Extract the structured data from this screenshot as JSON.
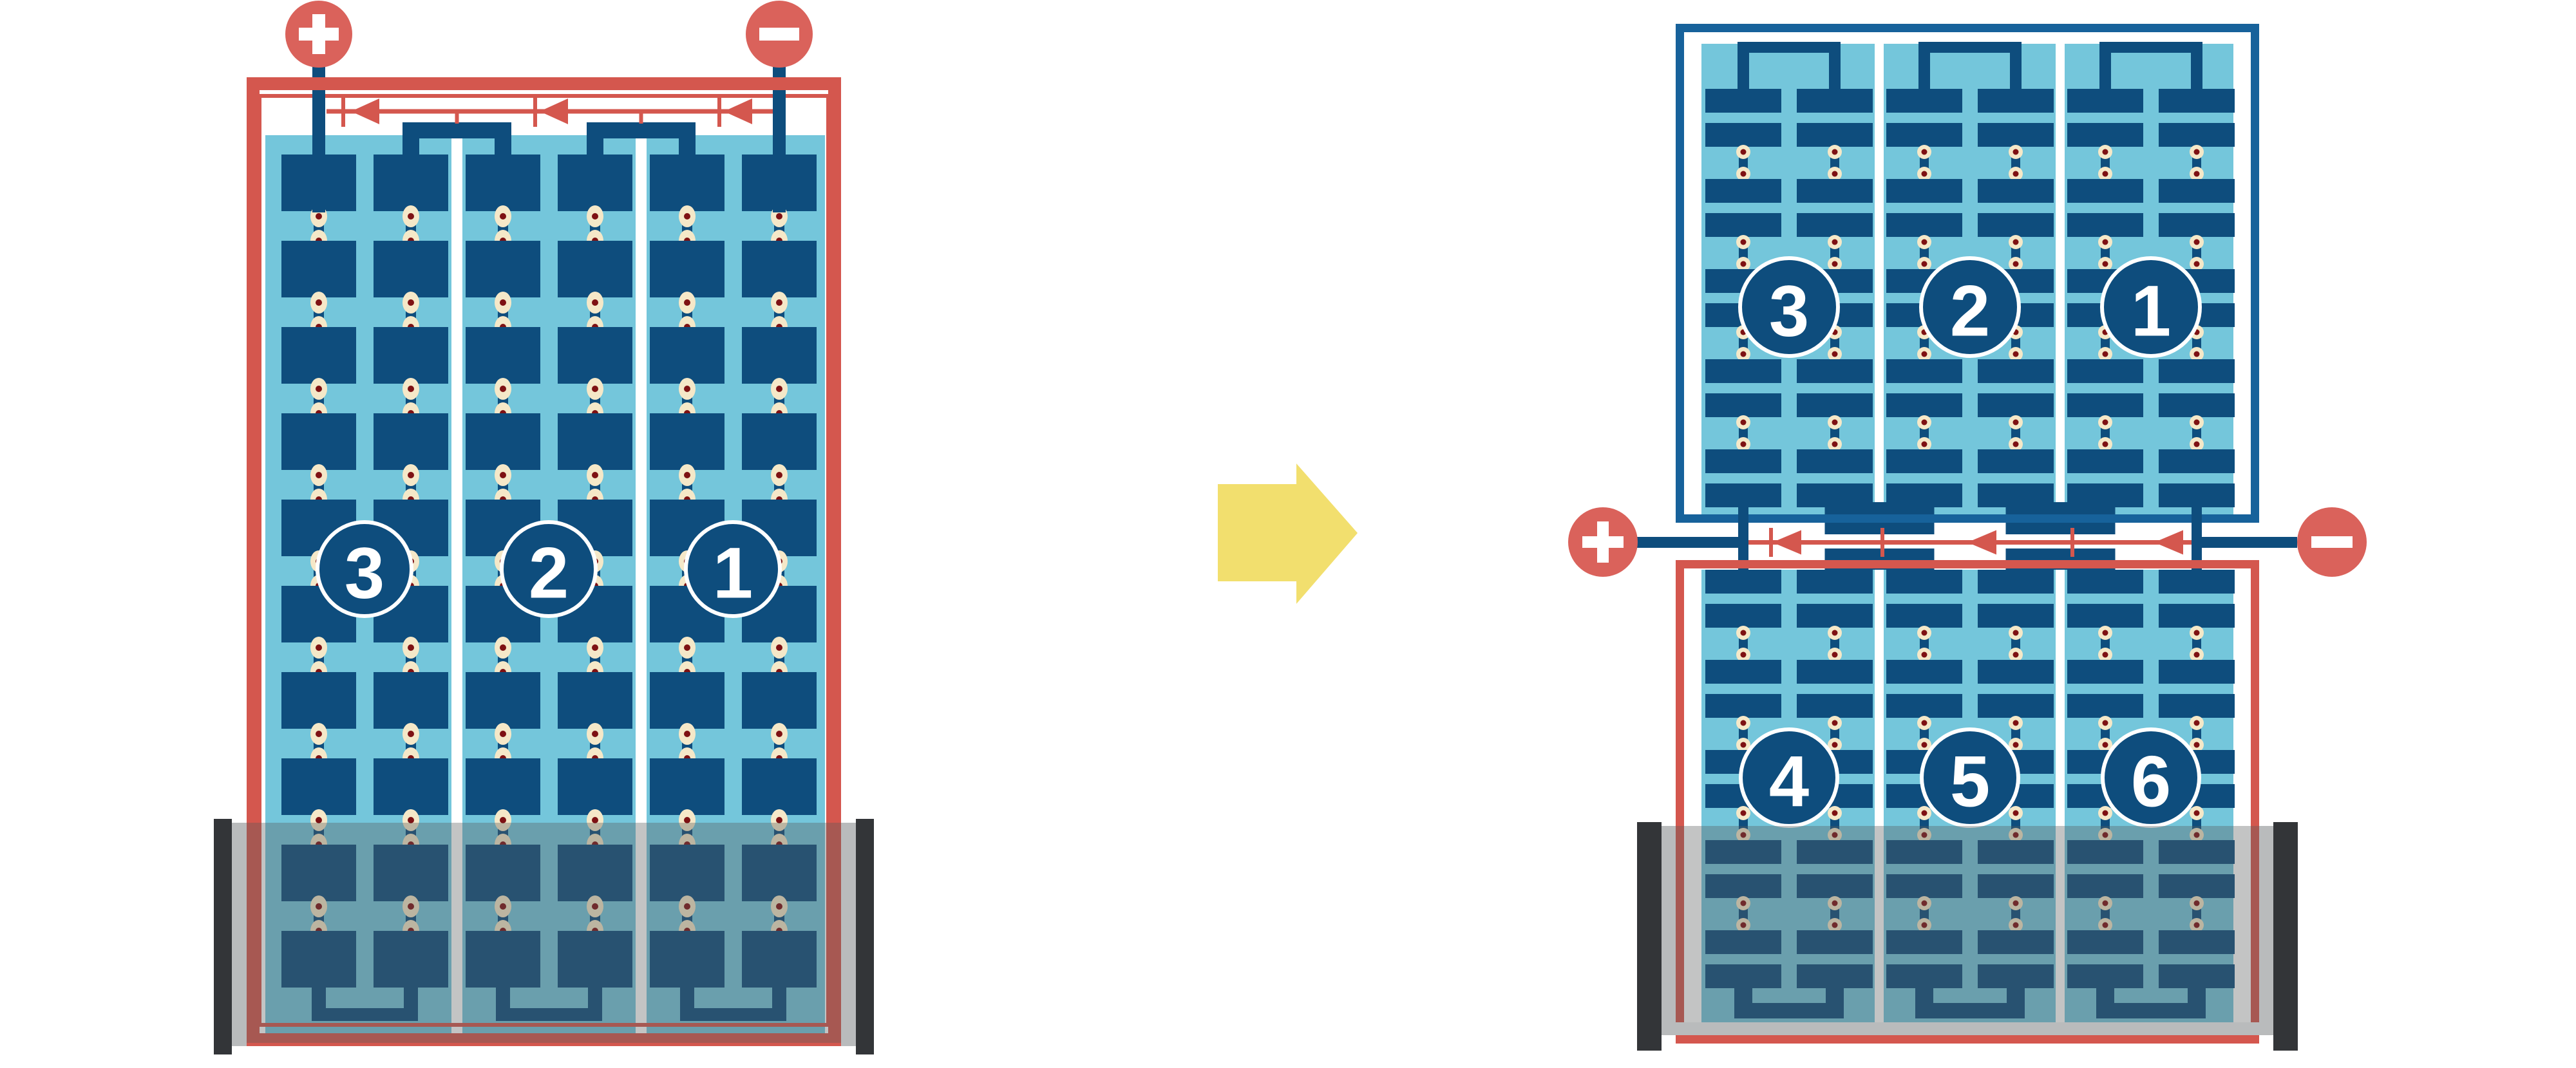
{
  "diagram": {
    "kind": "battery-cell-series-diagram",
    "transform_arrow_direction": "right"
  },
  "colors": {
    "red": "#D4574E",
    "red_terminal": "#DA625B",
    "dark_blue": "#0E4D7D",
    "frame_blue": "#17629B",
    "light_blue": "#74C6DB",
    "cream": "#F5E8C8",
    "dot_red": "#7E1113",
    "yellow": "#F2DF6E",
    "tray_overlay": "#585C5C",
    "tray_overlay_opacity": 0.36,
    "wall_gray": "#B9BBBC",
    "cap_black": "#333538",
    "white": "#FFFFFF"
  },
  "left_battery": {
    "terminal_positive": "+",
    "terminal_negative": "−",
    "cell_labels": [
      "3",
      "2",
      "1"
    ],
    "cell_count": 3,
    "plate_columns_per_cell": 2,
    "plate_rows": 10,
    "current_arrow_direction": "left",
    "series_bridges": 2
  },
  "right_battery": {
    "top_module": {
      "cell_labels": [
        "3",
        "2",
        "1"
      ],
      "plate_rows": 10
    },
    "bottom_module": {
      "cell_labels": [
        "4",
        "5",
        "6"
      ],
      "plate_rows": 10
    },
    "terminal_positive": "+",
    "terminal_negative": "−",
    "current_arrow_direction": "left",
    "inter_module_links": 2
  }
}
